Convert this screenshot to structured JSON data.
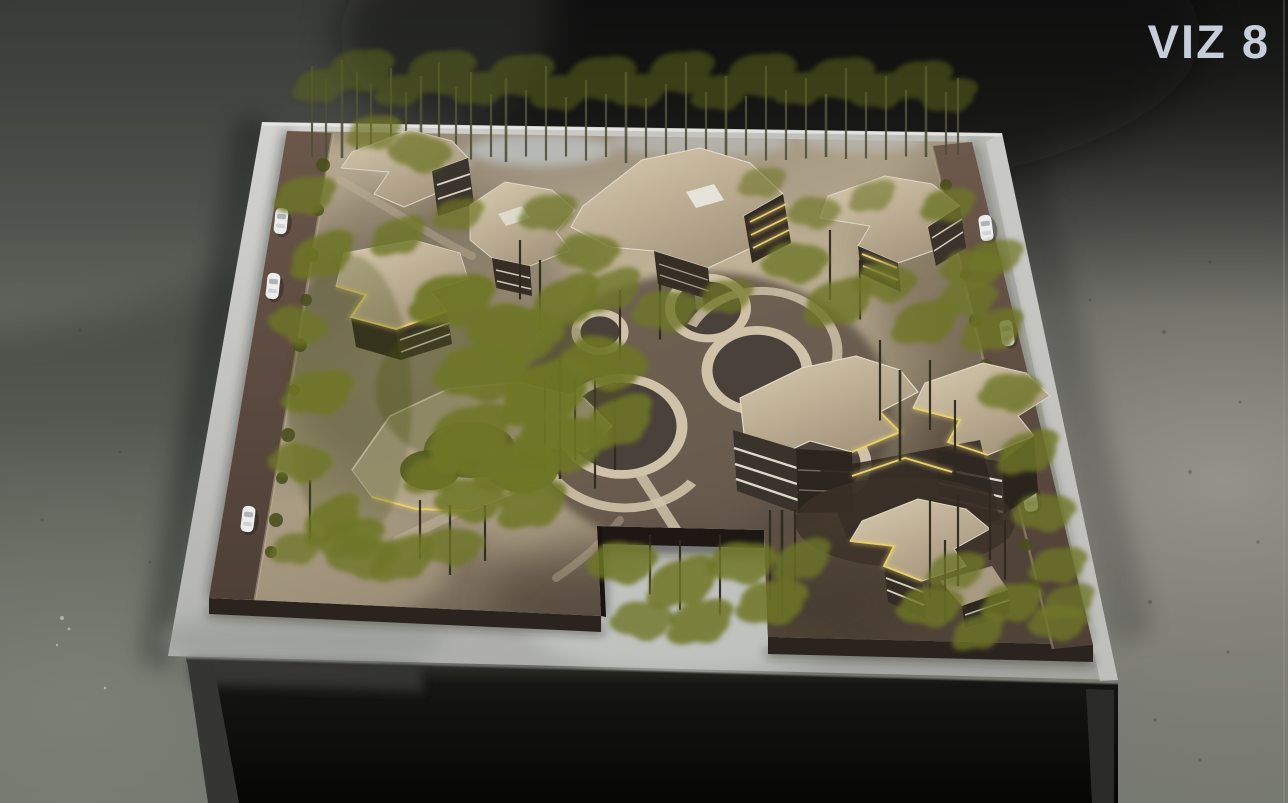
{
  "watermark": {
    "text": "VIZ 8",
    "color": "#c7cdda"
  },
  "palette": {
    "floor_top": "#2e2f2a",
    "floor_bottom": "#70746b",
    "floor_right": "#94928b",
    "table_surface": "#b6b7b3",
    "under_table": "#060605",
    "slab_side": "#2b241e",
    "ground": "#b3a68c",
    "ground_shadow": "#4c4136",
    "road": "#6b574a",
    "car": "#eceded",
    "roof": "#d9cbb0",
    "roof_shade": "#a3947b",
    "facade": "#362e25",
    "facade_band": "#ddd8cb",
    "accent_glow": "#e9d06e",
    "foliage": "#6f7626",
    "foliage_dark": "#5a641c",
    "trunk": "#2e2b1d",
    "trunk_back": "#50503a",
    "plaza_circle": "#4a413a",
    "plaza_path": "#cfc2a8",
    "haze": "#c3ccd2"
  }
}
